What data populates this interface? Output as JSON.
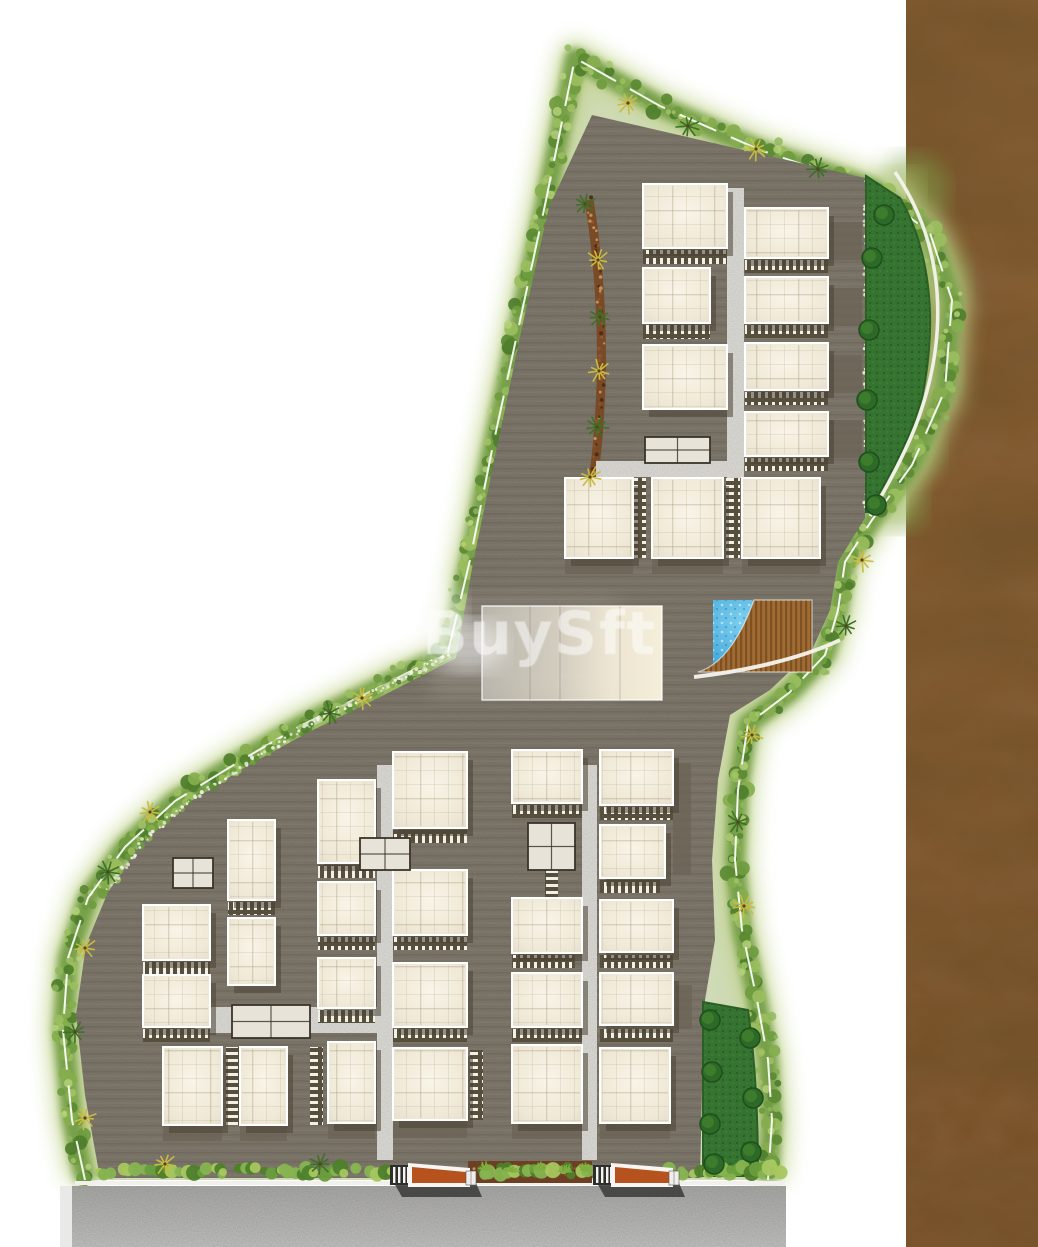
{
  "canvas": {
    "width": 1038,
    "height": 1247
  },
  "watermark": {
    "text": "BuySft",
    "x": 422,
    "y": 654,
    "font_size": 60,
    "letter_spacing": 1.5,
    "opacity": 0.52,
    "color": "#ffffff"
  },
  "palette": {
    "page_bg": "#ffffff",
    "pavement": "#7b7468",
    "band_fill": "#94ad5e",
    "band_glow": "#c3d48e",
    "band_stroke": "#77a04a",
    "shrubs": [
      "#6f9c3f",
      "#86ae4e",
      "#5b8a33",
      "#9abe5e",
      "#4f7e2c"
    ],
    "shrubs_light": [
      "#a4c468",
      "#b6d27c",
      "#8fb85c"
    ],
    "white_edge": "#ffffff",
    "mulch": "#7a4a27",
    "mulch_dots": [
      "#4a2a12",
      "#8a5a30",
      "#c89a60"
    ],
    "pebbles": [
      "#efe9dc",
      "#d8d2c2"
    ],
    "lawn": "#357330",
    "lawn_edge": "#2a5f26",
    "tree_dark": "#2d6a27",
    "tree_ring": "#1f4f1c",
    "tree_light": "#3f7d2f",
    "road": "#d9d7d3",
    "building_edge": "#ffffff",
    "building_hi": "#f8f4e7",
    "building_mid": "#efe8d6",
    "building_lo": "#e6decb",
    "shadow": "#4a4435",
    "patio": "#6b6455",
    "parking_base": "#564f3e",
    "parking_tick": "#f2efe4",
    "utility_fill": "#e7e3d8",
    "utility_wall": "#39342a",
    "club_l": "#b3aea3",
    "club_m": "#cfc9b9",
    "club_r": "#f5eedb",
    "pool_light": "#7fd0f0",
    "pool_deep": "#2f9cd4",
    "deck": "#a06c33",
    "deck_plank": "#603a14",
    "leather_top": "#8f6134",
    "leather_bottom": "#7b4d26",
    "gate_orange": "#b5521e",
    "gate_frame": "#f7f6f2",
    "gate_dark": "#3c3c3a",
    "gate_bars_bg": "#2e2e2c",
    "hedge_greens": [
      "#4e7f2b",
      "#699e3c",
      "#86b450",
      "#a7c75f"
    ],
    "wall_line": "#f1f0ec",
    "bottom_road_top": "#a4a4a2",
    "bottom_road_bottom": "#bdbdbb",
    "burst_green": "#3e7026",
    "burst_yellow": "#c9bb42"
  },
  "site": {
    "band_d": "M 85 1180 L 72 1120 L 63 1030 L 68 958 L 88 898 L 125 847 L 175 801 L 240 761 L 300 726 L 380 687 L 448 652 L 470 560 L 492 450 L 518 330 L 545 205 L 575 58 L 660 106 L 760 150 L 872 188 L 930 233 L 952 300 L 945 390 L 912 465 L 872 520 L 845 562 L 838 610 L 825 655 L 790 692 L 748 724 L 738 790 L 735 860 L 742 930 L 757 1000 L 768 1060 L 772 1120 L 768 1180",
    "band_fill_d": "M 85 1180 L 72 1120 L 63 1030 L 68 958 L 88 898 L 125 847 L 175 801 L 240 761 L 300 726 L 380 687 L 448 652 L 470 560 L 492 450 L 518 330 L 545 205 L 575 58 L 660 106 L 760 150 L 872 188 L 930 233 L 952 300 L 945 390 L 912 465 L 872 520 L 845 562 L 838 610 L 825 655 L 790 692 L 748 724 L 738 790 L 735 860 L 742 930 L 757 1000 L 768 1060 L 772 1120 L 768 1180 Z",
    "pavement_d": "M 592 115 L 865 178 L 865 518 L 838 562 L 830 610 L 812 650 L 770 690 L 730 715 L 718 780 L 712 860 L 715 940 L 705 1000 L 702 1090 L 700 1178 L 100 1178 L 85 1095 L 76 1015 L 86 945 L 108 892 L 142 843 L 188 803 L 247 766 L 307 733 L 388 693 L 456 658 L 473 563 L 496 452 L 521 332 L 549 207 Z",
    "mulch_d": "M 589 200 C 598 255 603 320 601 385 C 599 440 595 470 590 500",
    "pebble_d": "M 866 182 L 866 514",
    "hedge_neck_d": "M 298 730 L 450 655",
    "hedge_left_d": "M 108 888 L 145 840 L 190 800 L 248 763 L 300 730",
    "lawn_upper_d": "M 866 176 L 900 198 C 930 250 938 320 922 398 C 910 440 888 480 868 512 L 866 512 Z",
    "lawn_path_d": "M 895 172 C 945 245 950 335 916 425 C 903 458 884 492 870 516",
    "lawn_lower_d": "M 703 1002 L 748 1010 C 755 1060 758 1110 758 1176 L 703 1176 Z",
    "deck_d": "M 754 600 L 812 600 L 812 672 L 698 672 C 722 665 741 637 754 600 Z",
    "deck_path_d": "M 694 677 C 745 671 800 659 840 640"
  },
  "features": {
    "leather": {
      "x": 906,
      "y": 0,
      "w": 132,
      "h": 1247
    },
    "leather_green_blobs": [
      [
        912,
        190,
        36
      ],
      [
        925,
        280,
        42
      ],
      [
        918,
        370,
        40
      ],
      [
        908,
        450,
        34
      ],
      [
        900,
        505,
        26
      ]
    ],
    "roads": [
      [
        727,
        188,
        17,
        290
      ],
      [
        596,
        461,
        131,
        16
      ],
      [
        377,
        765,
        16,
        395
      ],
      [
        582,
        765,
        15,
        395
      ],
      [
        195,
        1007,
        182,
        26
      ]
    ],
    "buildings": [
      [
        643,
        184,
        84,
        64
      ],
      [
        643,
        268,
        67,
        55
      ],
      [
        643,
        345,
        84,
        64
      ],
      [
        565,
        478,
        68,
        80
      ],
      [
        652,
        478,
        71,
        80
      ],
      [
        742,
        478,
        78,
        80
      ],
      [
        745,
        208,
        83,
        50
      ],
      [
        745,
        277,
        83,
        46
      ],
      [
        745,
        343,
        83,
        47
      ],
      [
        745,
        412,
        83,
        44
      ],
      [
        318,
        780,
        57,
        83
      ],
      [
        318,
        882,
        57,
        53
      ],
      [
        318,
        958,
        57,
        50
      ],
      [
        328,
        1042,
        47,
        81
      ],
      [
        393,
        752,
        74,
        76
      ],
      [
        393,
        870,
        74,
        65
      ],
      [
        393,
        963,
        74,
        64
      ],
      [
        393,
        1048,
        74,
        72
      ],
      [
        512,
        750,
        70,
        53
      ],
      [
        512,
        898,
        70,
        55
      ],
      [
        512,
        973,
        70,
        54
      ],
      [
        512,
        1045,
        70,
        78
      ],
      [
        600,
        750,
        73,
        55
      ],
      [
        600,
        825,
        65,
        53
      ],
      [
        600,
        900,
        73,
        52
      ],
      [
        600,
        973,
        73,
        52
      ],
      [
        600,
        1048,
        70,
        75
      ],
      [
        143,
        905,
        67,
        55
      ],
      [
        143,
        975,
        67,
        52
      ],
      [
        163,
        1047,
        59,
        78
      ],
      [
        228,
        820,
        47,
        80
      ],
      [
        228,
        918,
        47,
        67
      ],
      [
        240,
        1047,
        47,
        78
      ]
    ],
    "parking_h": [
      [
        643,
        250,
        84,
        14
      ],
      [
        643,
        325,
        67,
        14
      ],
      [
        745,
        260,
        83,
        13
      ],
      [
        745,
        325,
        83,
        13
      ],
      [
        745,
        392,
        83,
        13
      ],
      [
        745,
        458,
        83,
        13
      ],
      [
        318,
        865,
        57,
        13
      ],
      [
        318,
        937,
        57,
        13
      ],
      [
        318,
        1010,
        57,
        13
      ],
      [
        393,
        830,
        74,
        13
      ],
      [
        393,
        937,
        74,
        13
      ],
      [
        393,
        1029,
        74,
        13
      ],
      [
        512,
        805,
        70,
        13
      ],
      [
        512,
        955,
        63,
        13
      ],
      [
        512,
        1029,
        70,
        13
      ],
      [
        600,
        807,
        73,
        13
      ],
      [
        600,
        880,
        60,
        13
      ],
      [
        600,
        955,
        73,
        13
      ],
      [
        600,
        1029,
        73,
        13
      ],
      [
        143,
        962,
        67,
        13
      ],
      [
        143,
        1029,
        67,
        13
      ],
      [
        228,
        902,
        47,
        13
      ]
    ],
    "parking_v": [
      [
        633,
        478,
        13,
        80
      ],
      [
        726,
        478,
        14,
        80
      ],
      [
        545,
        847,
        13,
        50
      ],
      [
        226,
        1047,
        13,
        78
      ],
      [
        310,
        1047,
        13,
        78
      ],
      [
        470,
        1050,
        13,
        70
      ]
    ],
    "utilities": [
      [
        645,
        437,
        65,
        26
      ],
      [
        528,
        823,
        47,
        47
      ],
      [
        173,
        858,
        40,
        30
      ],
      [
        232,
        1005,
        78,
        33
      ],
      [
        360,
        838,
        50,
        32
      ]
    ],
    "patios": [
      [
        828,
        222,
        34,
        38
      ],
      [
        828,
        288,
        34,
        38
      ],
      [
        828,
        355,
        34,
        38
      ],
      [
        828,
        420,
        34,
        38
      ],
      [
        673,
        763,
        18,
        112
      ],
      [
        676,
        985,
        16,
        44
      ],
      [
        565,
        558,
        68,
        16
      ],
      [
        652,
        558,
        71,
        16
      ],
      [
        742,
        558,
        78,
        16
      ],
      [
        163,
        1125,
        59,
        16
      ],
      [
        240,
        1125,
        47,
        16
      ],
      [
        328,
        1123,
        47,
        16
      ],
      [
        393,
        1120,
        74,
        18
      ],
      [
        512,
        1123,
        70,
        16
      ],
      [
        600,
        1123,
        70,
        16
      ]
    ],
    "clubhouse": [
      482,
      606,
      180,
      94
    ],
    "pool": [
      713,
      600,
      99,
      72
    ],
    "trees": [
      [
        872,
        258
      ],
      [
        869,
        330
      ],
      [
        867,
        400
      ],
      [
        869,
        462
      ],
      [
        876,
        505
      ],
      [
        710,
        1020
      ],
      [
        712,
        1072
      ],
      [
        710,
        1124
      ],
      [
        714,
        1164
      ],
      [
        750,
        1038
      ],
      [
        753,
        1098
      ],
      [
        751,
        1152
      ],
      [
        884,
        215
      ]
    ],
    "bursts": [
      [
        628,
        103,
        "y"
      ],
      [
        688,
        126,
        "g"
      ],
      [
        756,
        149,
        "y"
      ],
      [
        818,
        169,
        "g"
      ],
      [
        585,
        204,
        "g"
      ],
      [
        598,
        260,
        "y"
      ],
      [
        600,
        317,
        "g"
      ],
      [
        599,
        371,
        "y"
      ],
      [
        597,
        427,
        "g"
      ],
      [
        590,
        477,
        "y"
      ],
      [
        362,
        698,
        "y"
      ],
      [
        330,
        713,
        "g"
      ],
      [
        150,
        812,
        "y"
      ],
      [
        108,
        872,
        "g"
      ],
      [
        85,
        948,
        "y"
      ],
      [
        75,
        1032,
        "g"
      ],
      [
        85,
        1118,
        "y"
      ],
      [
        165,
        1164,
        "y"
      ],
      [
        320,
        1164,
        "g"
      ],
      [
        752,
        735,
        "y"
      ],
      [
        738,
        822,
        "g"
      ],
      [
        744,
        906,
        "y"
      ],
      [
        846,
        626,
        "g"
      ],
      [
        862,
        560,
        "y"
      ]
    ],
    "gates": [
      [
        390,
        1163
      ],
      [
        593,
        1163
      ]
    ],
    "hedge_segments": [
      [
        100,
        388
      ],
      [
        478,
        590
      ],
      [
        668,
        780
      ]
    ],
    "hedge_y": 1171,
    "mulch_bed": [
      468,
      1161,
      124,
      22
    ],
    "grass_tufts": [
      [
        485,
        1170
      ],
      [
        512,
        1172
      ],
      [
        540,
        1170
      ],
      [
        566,
        1172
      ],
      [
        585,
        1171
      ]
    ],
    "wall_line": [
      75,
      1181,
      710,
      4
    ],
    "bottom_road": [
      72,
      1186,
      714,
      61
    ],
    "road_left_strip": [
      60,
      1186,
      12,
      61
    ],
    "glow_spots": [
      [
        412,
        612,
        50,
        40
      ],
      [
        468,
        646,
        38,
        26
      ]
    ]
  }
}
